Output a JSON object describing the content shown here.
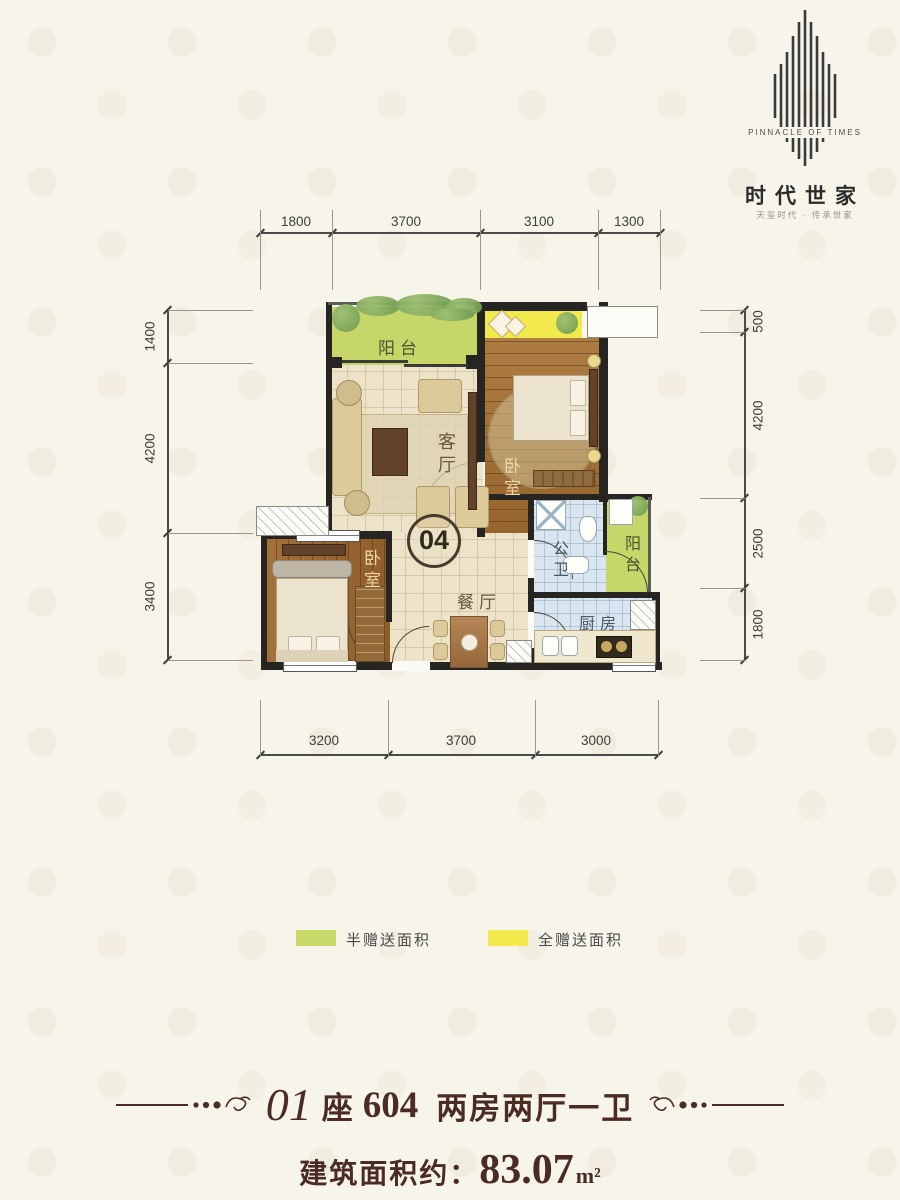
{
  "logo": {
    "title_en": "PINNACLE OF TIMES",
    "title_cn": "时代世家",
    "tagline": "天玺时代 · 传承世家"
  },
  "dims": {
    "top": [
      "1800",
      "3700",
      "3100",
      "1300"
    ],
    "left": [
      "1400",
      "4200",
      "3400"
    ],
    "right": [
      "500",
      "4200",
      "2500",
      "1800"
    ],
    "bottom": [
      "3200",
      "3700",
      "3000"
    ]
  },
  "unit_badge": "04",
  "rooms": {
    "balcony_top": "阳台",
    "living": "客厅",
    "bedroom_master": "卧室",
    "bedroom_second": "卧室",
    "bathroom": "公卫",
    "dining": "餐厅",
    "kitchen": "厨房",
    "balcony_right": "阳台"
  },
  "legend": {
    "half": {
      "color": "#c9d967",
      "label": "半赠送面积"
    },
    "full": {
      "color": "#f2eb4d",
      "label": "全赠送面积"
    }
  },
  "footer": {
    "unit_no": "01",
    "zuo": "座",
    "room_no": "604",
    "layout_desc": "两房两厅一卫",
    "area_label": "建筑面积约：",
    "area_value": "83.07",
    "area_unit": "m²"
  },
  "colors": {
    "accent_green": "#c6d669",
    "accent_yellow": "#f2e94c",
    "wall": "#262522",
    "footer_text": "#4b2b24"
  }
}
